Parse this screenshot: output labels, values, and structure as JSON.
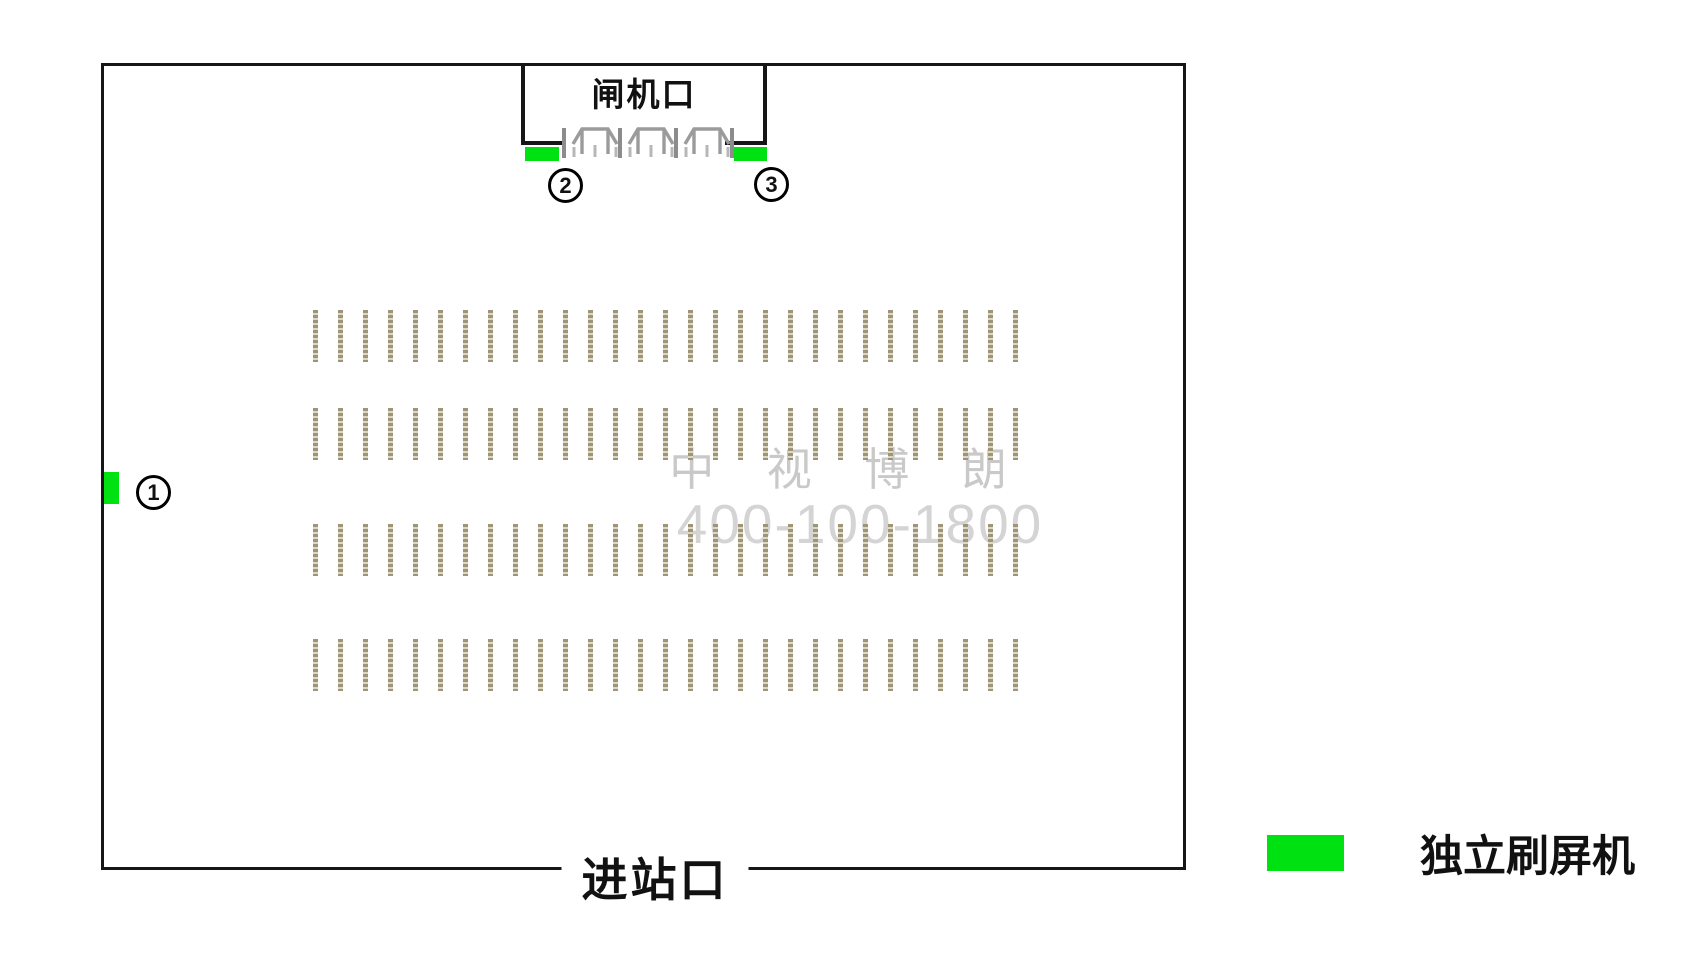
{
  "station": {
    "gate": {
      "label": "闸机口"
    },
    "entrance": {
      "label": "进站口"
    },
    "watermark": {
      "line1": "中 视 博 朗",
      "line2": "400-100-1800"
    },
    "markers": [
      {
        "num": "1",
        "location": "left-wall"
      },
      {
        "num": "2",
        "location": "gate-left"
      },
      {
        "num": "3",
        "location": "gate-right"
      }
    ],
    "legend": {
      "label": "独立刷屏机",
      "swatch_color": "#00e112"
    },
    "seating": {
      "rows": 4,
      "ticks_per_row": 29
    },
    "colors": {
      "screen_machine_green": "#00e112",
      "wall_black": "#161616",
      "tick_dark": "#9e9478",
      "tick_light": "#ddd7c5",
      "turnstile_gray": "#9b9b9b",
      "watermark_gray": "#c9c9c9"
    }
  }
}
